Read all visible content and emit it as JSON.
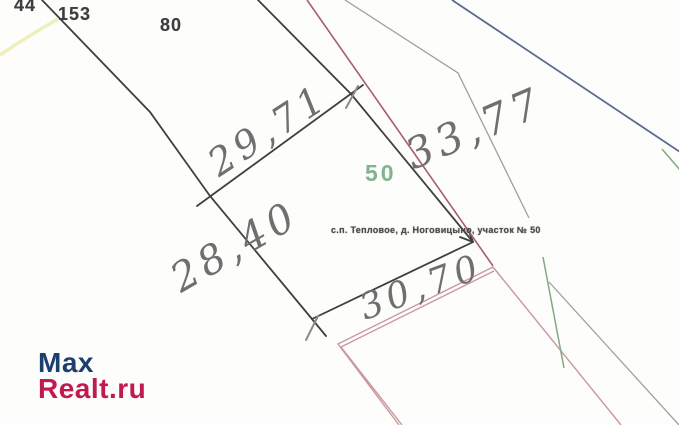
{
  "theme": {
    "paper": "#fdfdfb",
    "ink": "#3e3e3e",
    "pencil": "#6f6f6f",
    "boundary-black": "#3f3f3f",
    "line-red": "#a65f66",
    "line-pink": "#c9989d",
    "line-green": "#84a884",
    "line-olive": "#9aa496",
    "line-blue": "#5a6a90",
    "line-yellow": "#ededbb",
    "plot-green": "#6aa87c",
    "address-ink": "#4a4a4a",
    "logo-blue": "#1e3e6e",
    "logo-red": "#c11a4e"
  },
  "plan": {
    "neighbor_labels": [
      {
        "text": "44"
      },
      {
        "text": "153"
      },
      {
        "text": "80"
      }
    ],
    "plot_number": "50",
    "address": "с.п. Тепловое, д. Ноговицыно, участок № 50",
    "dimensions": {
      "north_west": "29,71",
      "north_east": "33,77",
      "south_west": "28,40",
      "south_east": "30,70"
    }
  },
  "watermark": {
    "line1": "Max",
    "line2": "Realt.ru"
  }
}
